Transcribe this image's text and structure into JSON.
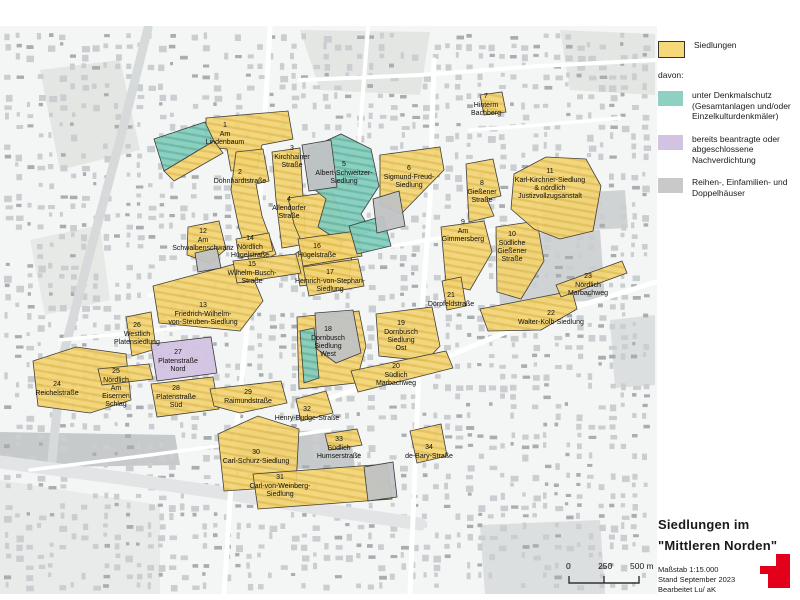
{
  "legend": {
    "siedlungen_label": "Siedlungen",
    "siedlungen_color": "#f6d878",
    "davon_label": "davon:",
    "items": [
      {
        "name": "denkmalschutz",
        "color": "#8ed0c1",
        "label": "unter Denkmalschutz (Gesamtanlagen und/oder Einzelkulturdenkmäler)"
      },
      {
        "name": "nachverdichtung",
        "color": "#d3c3e2",
        "label": "bereits beantragte oder abgeschlossene Nachverdichtung"
      },
      {
        "name": "reihenhaeuser",
        "color": "#c9c9c9",
        "label": "Reihen-, Einfamilien- und Doppelhäuser"
      }
    ]
  },
  "title_block": {
    "line1": "Siedlungen im",
    "line2": "\"Mittleren Norden\"",
    "scale": "Maßstab 1:15.000",
    "stand": "Stand September 2023",
    "bearbeitet": "Bearbeitet  Lu/ aK"
  },
  "scalebar": {
    "tick0": "0",
    "tick1": "250",
    "tick2": "500 m"
  },
  "map": {
    "colors": {
      "siedlung": "#f2d472",
      "denkmalschutz": "#85cdbe",
      "nachverdichtung": "#d2c3e1",
      "reihenhaeuser": "#c0c2c4"
    },
    "settlements": [
      {
        "num": "1",
        "name": "Am Lindenbaum",
        "fill": "yellow",
        "cx": 225,
        "ny": 127,
        "lines": [
          "Am",
          "Lindenbaum"
        ],
        "d": "M206,118 L288,111 L293,139 L262,145 L257,169 L231,171 L227,149 L206,147 Z"
      },
      {
        "num": "2",
        "name": "Dohnhardtstraße",
        "fill": "yellow",
        "cx": 240,
        "ny": 174,
        "lines": [
          "Dohnhardtstraße"
        ],
        "d": "M236,152 L263,149 L269,181 L256,184 L262,216 L276,254 L251,267 L239,228 L231,190 Z"
      },
      {
        "num": "3",
        "name": "Kirchhainer Straße",
        "fill": "yellow",
        "cx": 292,
        "ny": 150,
        "lines": [
          "Kirchhainer",
          "Straße"
        ],
        "d": "M272,152 L300,148 L306,244 L282,248 L276,200 Z"
      },
      {
        "num": "4",
        "name": "Allendorfer Straße",
        "fill": "yellow",
        "cx": 289,
        "ny": 201,
        "lines": [
          "Allendorfer",
          "Straße"
        ],
        "d": "M288,198 L332,192 L345,224 L340,252 L352,255 L349,280 L300,286 L295,254 L304,248 L294,224 Z"
      },
      {
        "num": "5",
        "name": "Albert-Schweitzer-Siedlung",
        "fill": "teal",
        "cx": 344,
        "ny": 166,
        "lines": [
          "Albert-Schweitzer-",
          "Siedlung"
        ],
        "d": "M308,149 L341,134 L371,149 L379,186 L361,214 L371,231 L341,242 L318,227 L326,199 L308,184 Z"
      },
      {
        "num": "6",
        "name": "Sigmund-Freud-Siedlung",
        "fill": "yellow",
        "cx": 409,
        "ny": 170,
        "lines": [
          "Sigmund-Freud-",
          "Siedlung"
        ],
        "d": "M380,155 L440,147 L444,170 L401,214 L380,204 Z"
      },
      {
        "num": "7",
        "name": "Hinterm Bachberg",
        "fill": "yellow",
        "cx": 486,
        "ny": 98,
        "lines": [
          "Hinterm",
          "Bachberg"
        ],
        "d": "M480,95 L502,92 L506,112 L484,115 Z"
      },
      {
        "num": "8",
        "name": "Gießener Straße",
        "fill": "yellow",
        "cx": 482,
        "ny": 185,
        "lines": [
          "Gießener",
          "Straße"
        ],
        "d": "M466,164 L493,159 L501,196 L487,199 L494,216 L469,222 Z"
      },
      {
        "num": "9",
        "name": "Am Gimmersberg",
        "fill": "yellow",
        "cx": 463,
        "ny": 224,
        "lines": [
          "Am",
          "Gimmersberg"
        ],
        "d": "M441,227 L484,221 L492,252 L470,290 L446,284 Z"
      },
      {
        "num": "10",
        "name": "Südliche Gießener Straße",
        "fill": "yellow",
        "cx": 512,
        "ny": 236,
        "lines": [
          "Südliche",
          "Gießener",
          "Straße"
        ],
        "d": "M496,227 L537,221 L544,261 L521,299 L497,292 Z"
      },
      {
        "num": "11",
        "name": "Karl-Kirchner-Siedlung & nördlich Justizvollzugsanstalt",
        "fill": "yellow",
        "cx": 550,
        "ny": 173,
        "lines": [
          "Karl-Kirchner-Siedlung",
          "& nördlich",
          "Justizvollzugsanstalt"
        ],
        "d": "M514,174 L546,157 L586,159 L601,186 L593,231 L560,239 L534,229 L511,209 Z"
      },
      {
        "num": "12",
        "name": "Am Schwalbenschwanz",
        "fill": "yellow",
        "cx": 203,
        "ny": 233,
        "lines": [
          "Am",
          "Schwalbenschwanz"
        ],
        "d": "M188,227 L219,221 L226,249 L210,263 L187,255 Z"
      },
      {
        "num": "13",
        "name": "Friedrich-Wilhelm-von-Steuben-Siedlung",
        "fill": "yellow",
        "cx": 203,
        "ny": 307,
        "lines": [
          "Friedrich-Wilhelm-",
          "von-Steuben-Siedlung"
        ],
        "d": "M153,286 L246,261 L263,301 L240,331 L159,323 Z"
      },
      {
        "num": "14",
        "name": "Nördlich Hügelstraße",
        "fill": "yellow",
        "cx": 250,
        "ny": 240,
        "lines": [
          "Nördlich",
          "Hügelstraße"
        ],
        "d": "M236,239 L269,233 L273,251 L239,258 Z"
      },
      {
        "num": "15",
        "name": "Wilhelm-Busch-Straße",
        "fill": "yellow",
        "cx": 252,
        "ny": 266,
        "lines": [
          "Wilhelm-Busch-",
          "Straße"
        ],
        "d": "M233,261 L296,254 L301,273 L237,283 Z"
      },
      {
        "num": "16",
        "name": "Hügelstraße",
        "fill": "yellow",
        "cx": 317,
        "ny": 248,
        "lines": [
          "Hügelstraße"
        ],
        "d": "M298,239 L357,231 L362,256 L303,266 Z"
      },
      {
        "num": "17",
        "name": "Heinrich-von-Stephan-Siedlung",
        "fill": "yellow",
        "cx": 330,
        "ny": 274,
        "lines": [
          "Heinrich-von-Stephan-",
          "Siedlung"
        ],
        "d": "M303,267 L358,259 L364,286 L309,296 Z"
      },
      {
        "num": "18",
        "name": "Dornbusch Siedlung West",
        "fill": "yellow",
        "cx": 328,
        "ny": 331,
        "lines": [
          "Dornbusch",
          "Siedlung",
          "West"
        ],
        "d": "M297,317 L359,311 L366,346 L356,383 L299,389 Z"
      },
      {
        "num": "19",
        "name": "Dornbusch Siedlung Ost",
        "fill": "yellow",
        "cx": 401,
        "ny": 325,
        "lines": [
          "Dornbusch",
          "Siedlung",
          "Ost"
        ],
        "d": "M376,314 L432,307 L440,346 L426,361 L379,356 Z"
      },
      {
        "num": "20",
        "name": "Südlich Marbachweg",
        "fill": "yellow",
        "cx": 396,
        "ny": 368,
        "lines": [
          "Südlich",
          "Marbachweg"
        ],
        "d": "M351,371 L446,351 L453,368 L358,392 Z"
      },
      {
        "num": "21",
        "name": "Dörpfeldstraße",
        "fill": "yellow",
        "cx": 451,
        "ny": 297,
        "lines": [
          "Dörpfeldstraße"
        ],
        "d": "M442,281 L461,277 L466,306 L447,310 Z"
      },
      {
        "num": "22",
        "name": "Walter-Kolb-Siedlung",
        "fill": "yellow",
        "cx": 551,
        "ny": 315,
        "lines": [
          "Walter-Kolb-Siedlung"
        ],
        "d": "M480,309 L572,291 L577,309 L541,330 L488,331 Z"
      },
      {
        "num": "23",
        "name": "Nördlich Marbachweg",
        "fill": "yellow",
        "cx": 588,
        "ny": 278,
        "lines": [
          "Nördlich",
          "Marbachweg"
        ],
        "d": "M556,285 L622,261 L627,273 L561,297 Z"
      },
      {
        "num": "24",
        "name": "Reichelstraße",
        "fill": "yellow",
        "cx": 57,
        "ny": 386,
        "lines": [
          "Reichelstraße"
        ],
        "d": "M33,361 L76,347 L126,354 L131,400 L90,413 L38,406 Z"
      },
      {
        "num": "25",
        "name": "Nördlich Am Eisernen Schlag",
        "fill": "yellow",
        "cx": 116,
        "ny": 373,
        "lines": [
          "Nördlich",
          "Am",
          "Eisernen",
          "Schlag"
        ],
        "d": "M98,369 L149,364 L153,379 L102,385 Z"
      },
      {
        "num": "26",
        "name": "Westlich Platensiedlung",
        "fill": "yellow",
        "cx": 137,
        "ny": 327,
        "lines": [
          "Westlich",
          "Platensiedlung"
        ],
        "d": "M126,317 L151,312 L156,349 L132,356 Z"
      },
      {
        "num": "27",
        "name": "Platenstraße Nord",
        "fill": "purple",
        "cx": 178,
        "ny": 354,
        "lines": [
          "Platenstraße",
          "Nord"
        ],
        "d": "M151,344 L211,337 L217,373 L157,381 Z"
      },
      {
        "num": "28",
        "name": "Platenstraße Süd",
        "fill": "yellow",
        "cx": 176,
        "ny": 390,
        "lines": [
          "Platenstraße",
          "Süd"
        ],
        "d": "M151,384 L213,377 L219,409 L157,417 Z"
      },
      {
        "num": "29",
        "name": "Raimundstraße",
        "fill": "yellow",
        "cx": 248,
        "ny": 394,
        "lines": [
          "Raimundstraße"
        ],
        "d": "M210,389 L281,381 L287,403 L240,413 L214,406 Z"
      },
      {
        "num": "30",
        "name": "Carl-Schurz-Siedlung",
        "fill": "yellow",
        "cx": 256,
        "ny": 454,
        "lines": [
          "Carl-Schurz-Siedlung"
        ],
        "d": "M218,434 L258,416 L299,429 L296,486 L224,491 Z"
      },
      {
        "num": "31",
        "name": "Carl-von-Weinberg-Siedlung",
        "fill": "yellow",
        "cx": 280,
        "ny": 479,
        "lines": [
          "Carl-von-Weinberg-",
          "Siedlung"
        ],
        "d": "M253,474 L387,464 L392,499 L258,509 Z"
      },
      {
        "num": "32",
        "name": "Henry-Budge-Straße",
        "fill": "yellow",
        "cx": 307,
        "ny": 411,
        "lines": [
          "Henry-Budge-Straße"
        ],
        "d": "M296,399 L326,391 L333,413 L301,421 Z"
      },
      {
        "num": "33",
        "name": "Südlich Humserstraße",
        "fill": "yellow",
        "cx": 339,
        "ny": 441,
        "lines": [
          "Südlich",
          "Humserstraße"
        ],
        "d": "M325,434 L357,429 L362,445 L329,450 Z"
      },
      {
        "num": "34",
        "name": "de-Bary-Straße",
        "fill": "yellow",
        "cx": 429,
        "ny": 449,
        "lines": [
          "de-Bary-Straße"
        ],
        "d": "M410,431 L441,424 L447,456 L417,463 Z"
      }
    ],
    "patches": [
      {
        "name": "denkmalschutz-strip-am-lindenbaum",
        "fill": "teal",
        "d": "M154,139 L205,122 L214,141 L164,171 Z"
      },
      {
        "name": "siedlung-strip-am-lindenbaum",
        "fill": "yellow",
        "d": "M164,171 L214,141 L223,153 L174,181 Z"
      },
      {
        "name": "reihenhaeuser-kirchhainer",
        "fill": "gray",
        "d": "M302,145 L331,140 L337,187 L309,191 Z"
      },
      {
        "name": "denkmalschutz-albert-schweitzer-sued",
        "fill": "teal",
        "d": "M349,226 L383,216 L391,246 L357,254 Z"
      },
      {
        "name": "reihenhaeuser-sigmund-freud",
        "fill": "gray",
        "d": "M373,199 L399,191 L405,226 L377,233 Z"
      },
      {
        "name": "reihenhaeuser-am-schwalbenschwanz",
        "fill": "gray",
        "d": "M195,253 L217,248 L221,268 L198,272 Z"
      },
      {
        "name": "reihenhaeuser-dornbusch-west",
        "fill": "gray",
        "d": "M315,313 L353,310 L361,353 L336,363 L317,349 Z"
      },
      {
        "name": "denkmalschutz-strip-dornbusch-west",
        "fill": "teal",
        "d": "M300,331 L314,328 L319,378 L304,383 Z"
      },
      {
        "name": "reihenhaeuser-carl-von-weinberg",
        "fill": "gray",
        "d": "M364,467 L393,462 L397,497 L368,501 Z"
      }
    ]
  }
}
